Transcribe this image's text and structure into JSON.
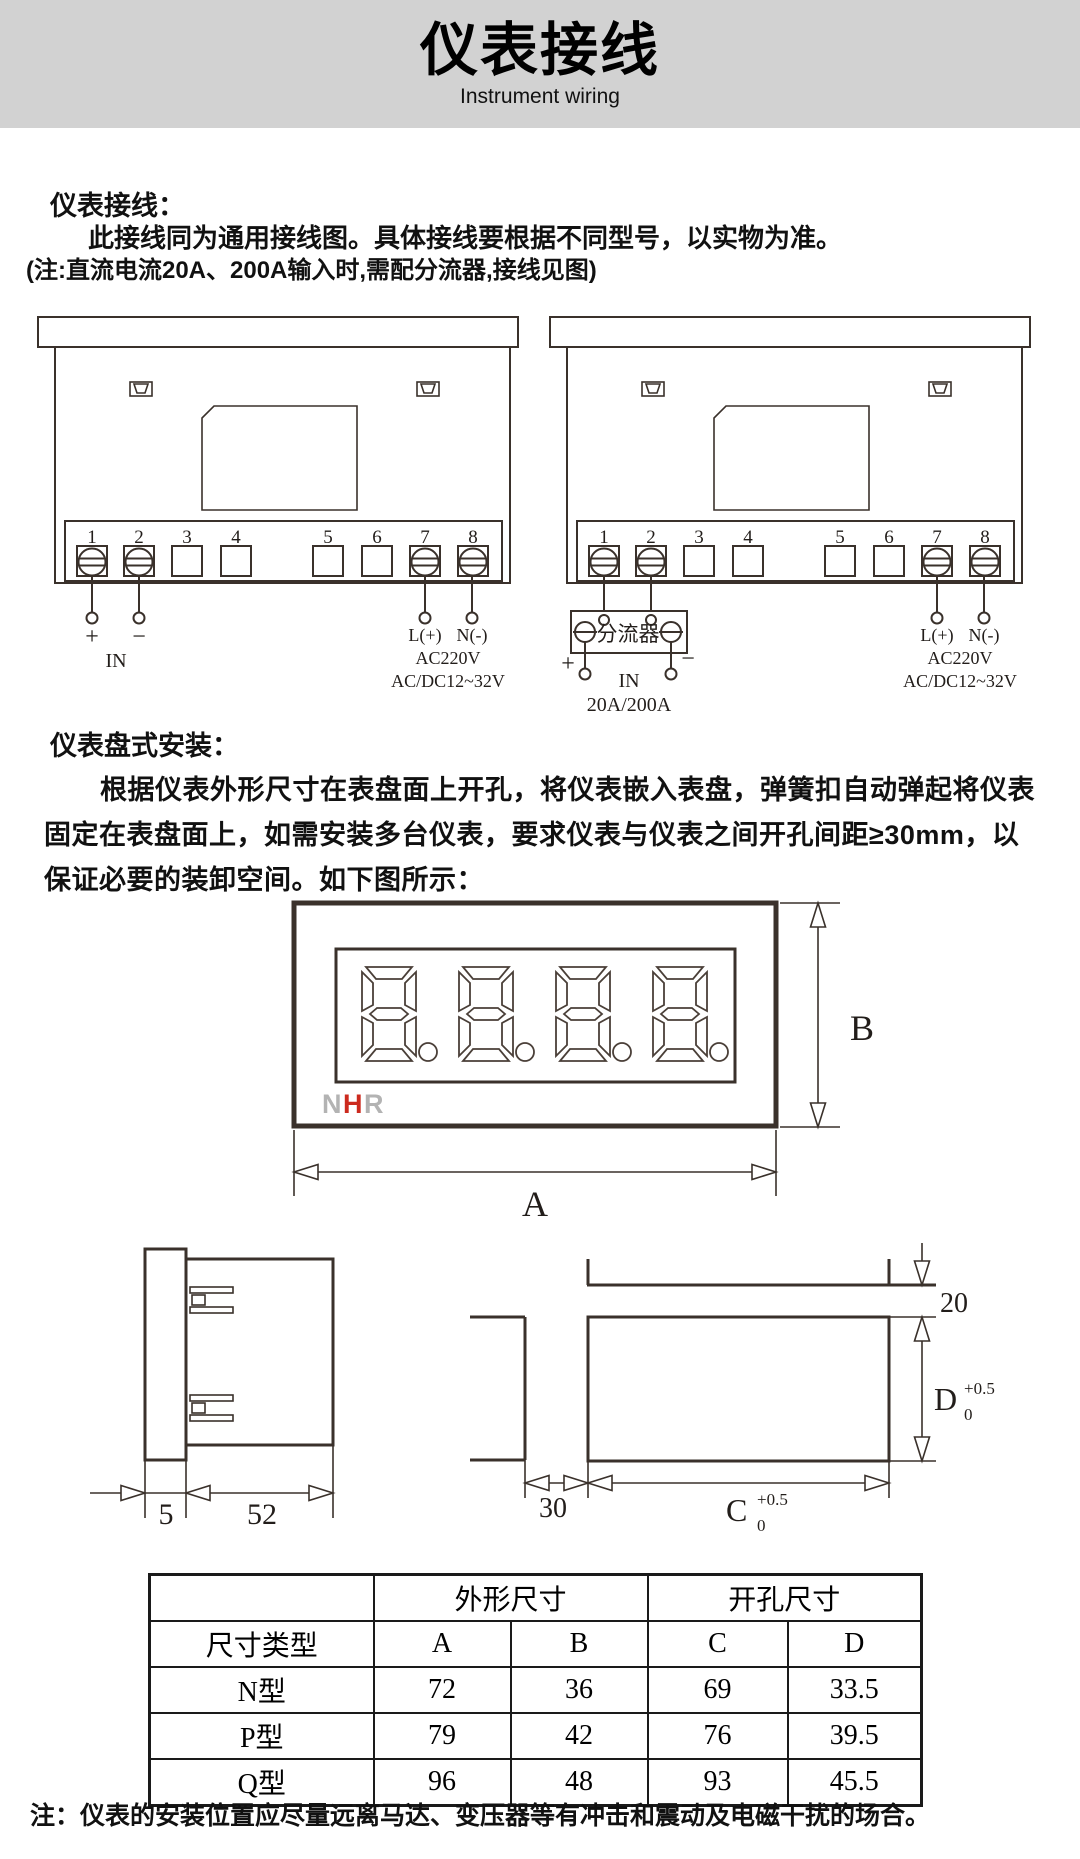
{
  "header": {
    "title": "仪表接线",
    "subtitle": "Instrument wiring"
  },
  "wiring": {
    "heading": "仪表接线：",
    "lead": "此接线同为通用接线图。具体接线要根据不同型号，以实物为准。",
    "note": "(注:直流电流20A、200A输入时,需配分流器,接线见图)",
    "terminals": [
      "1",
      "2",
      "3",
      "4",
      "5",
      "6",
      "7",
      "8"
    ],
    "left": {
      "plus": "+",
      "minus": "−",
      "in_label": "IN",
      "l_label": "L(+)",
      "n_label": "N(-)",
      "v1": "AC220V",
      "v2": "AC/DC12~32V"
    },
    "right": {
      "shunt": "分流器",
      "plus": "+",
      "minus": "−",
      "in_label": "IN",
      "range": "20A/200A",
      "l_label": "L(+)",
      "n_label": "N(-)",
      "v1": "AC220V",
      "v2": "AC/DC12~32V"
    }
  },
  "install": {
    "heading": "仪表盘式安装：",
    "line1": "根据仪表外形尺寸在表盘面上开孔，将仪表嵌入表盘，弹簧扣自动弹起将仪表",
    "line2": "固定在表盘面上，如需安装多台仪表，要求仪表与仪表之间开孔间距≥30mm，以",
    "line3": "保证必要的装卸空间。如下图所示：",
    "logo": {
      "n": "N",
      "h": "H",
      "r": "R"
    },
    "dims": {
      "a": "A",
      "b": "B",
      "bezel": "5",
      "depth": "52",
      "v_gap": "20",
      "h_gap": "30",
      "c": "C",
      "c_sup": "+0.5",
      "c_sub": "0",
      "d": "D",
      "d_sup": "+0.5",
      "d_sub": "0"
    }
  },
  "size_table": {
    "outline_header": "外形尺寸",
    "cutout_header": "开孔尺寸",
    "type_header": "尺寸类型",
    "columns": [
      "A",
      "B",
      "C",
      "D"
    ],
    "rows": [
      {
        "type": "N型",
        "A": "72",
        "B": "36",
        "C": "69",
        "D": "33.5"
      },
      {
        "type": "P型",
        "A": "79",
        "B": "42",
        "C": "76",
        "D": "39.5"
      },
      {
        "type": "Q型",
        "A": "96",
        "B": "48",
        "C": "93",
        "D": "45.5"
      }
    ]
  },
  "footnote": "注：仪表的安装位置应尽量远离马达、变压器等有冲击和震动及电磁干扰的场合。",
  "colors": {
    "line": "#3a312b",
    "logo_red": "#cc2a1e",
    "logo_gray": "#b3b3b3",
    "band_bg": "#d2d2d2"
  }
}
